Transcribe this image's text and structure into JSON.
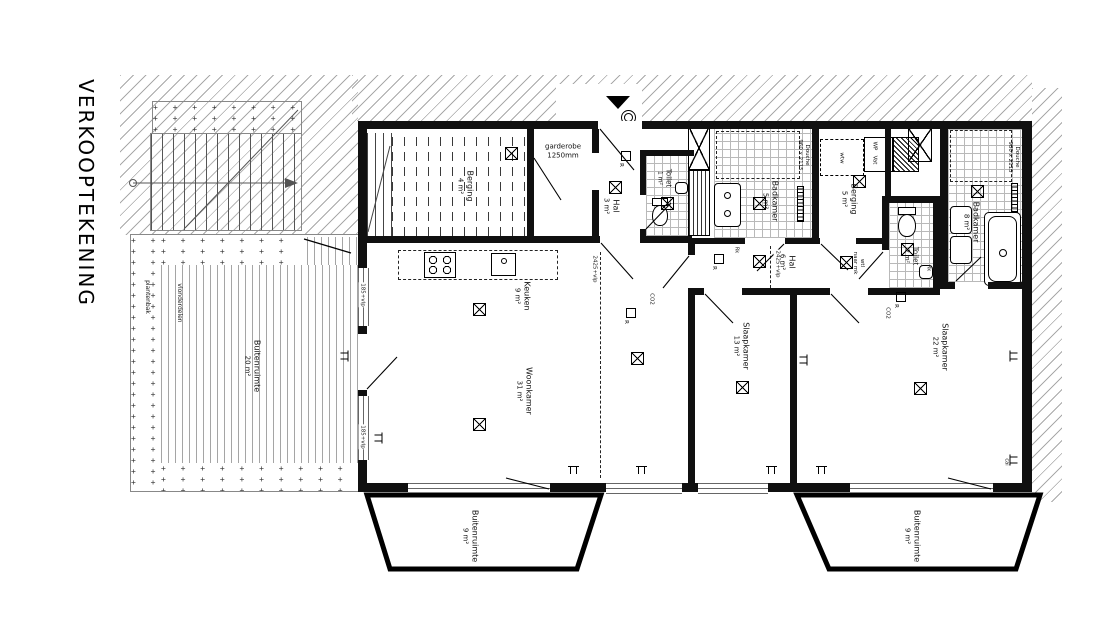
{
  "title": "VERKOOPTEKENING",
  "outdoor": {
    "terrace": {
      "name": "Buitenruimte",
      "area": "20 m²",
      "planter": "plantenbak",
      "decking": "vlonderdelen"
    },
    "balcony_left": {
      "name": "Buitenruimte",
      "area": "9 m²"
    },
    "balcony_right": {
      "name": "Buitenruimte",
      "area": "9 m²"
    }
  },
  "rooms": {
    "berging_small": {
      "name": "Berging",
      "area": "4 m²"
    },
    "garderobe": {
      "name": "garderobe",
      "dim": "1250mm"
    },
    "hal_entree": {
      "name": "Hal",
      "area": "3 m²"
    },
    "toilet_small": {
      "name": "Toilet",
      "area": "1 m²"
    },
    "badkamer_small": {
      "name": "Badkamer",
      "area": "5 m²",
      "douche_name": "Douche",
      "douche_dim": "960 x 2115"
    },
    "berging_large": {
      "name": "Berging",
      "area": "5 m²"
    },
    "badkamer_large": {
      "name": "Badkamer",
      "area": "8 m²",
      "douche_name": "Douche",
      "douche_dim": "980 x 2115"
    },
    "hal_middle": {
      "name": "Hal",
      "area": "6 m²"
    },
    "toilet_large": {
      "name": "Toilet",
      "area": "2 m²"
    },
    "keuken": {
      "name": "Keuken",
      "area": "9 m²"
    },
    "woonkamer": {
      "name": "Woonkamer",
      "area": "31 m²"
    },
    "slaapkamer_1": {
      "name": "Slaapkamer",
      "area": "13 m²"
    },
    "slaapkamer_2": {
      "name": "Slaapkamer",
      "area": "22 m²"
    }
  },
  "annotations": {
    "sill_height": "185+vlp",
    "ceiling_height": "2425+vlp",
    "co2": "CO2",
    "cai": "cai",
    "rk": "Rk",
    "wtl_line1": "wtl",
    "wtl_line2": "naar mk",
    "wtw": "wtw",
    "wp": "WP",
    "vat": "Vat",
    "switch": "R"
  },
  "colors": {
    "wall": "#101010",
    "hatch": "#a9a9a9",
    "tile": "#b9b9b9"
  }
}
